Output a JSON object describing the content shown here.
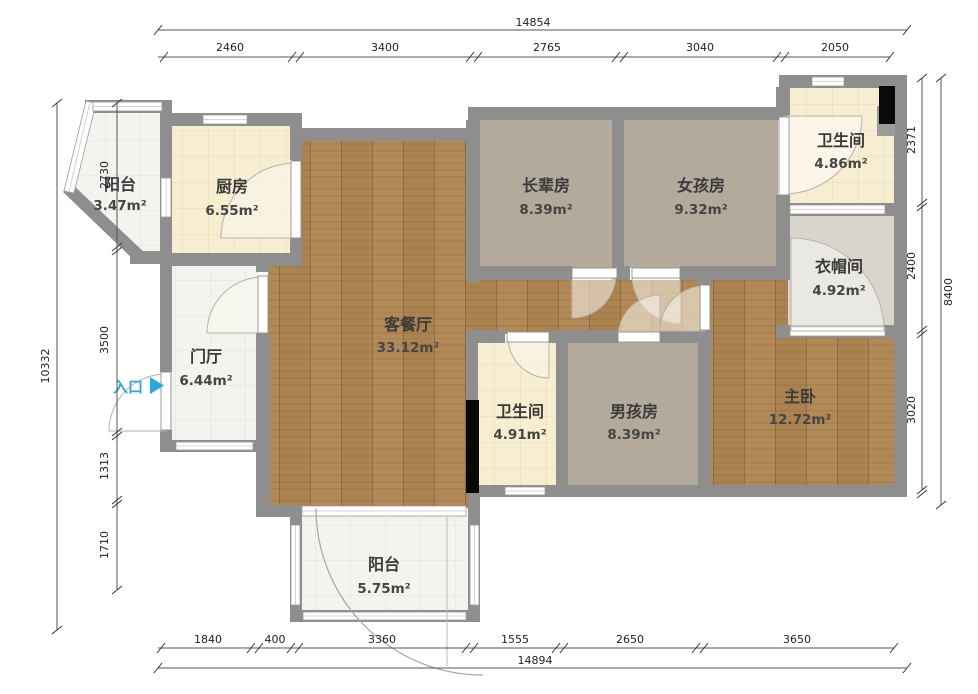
{
  "plan": {
    "title": "apartment floor plan"
  },
  "rooms": [
    {
      "id": "balcony-top",
      "name": "阳台",
      "area": "3.47m²"
    },
    {
      "id": "kitchen",
      "name": "厨房",
      "area": "6.55m²"
    },
    {
      "id": "living-dining",
      "name": "客餐厅",
      "area": "33.12m²"
    },
    {
      "id": "foyer",
      "name": "门厅",
      "area": "6.44m²"
    },
    {
      "id": "elder-room",
      "name": "长辈房",
      "area": "8.39m²"
    },
    {
      "id": "girl-room",
      "name": "女孩房",
      "area": "9.32m²"
    },
    {
      "id": "bathroom-top",
      "name": "卫生间",
      "area": "4.86m²"
    },
    {
      "id": "cloakroom",
      "name": "衣帽间",
      "area": "4.92m²"
    },
    {
      "id": "bathroom-mid",
      "name": "卫生间",
      "area": "4.91m²"
    },
    {
      "id": "boy-room",
      "name": "男孩房",
      "area": "8.39m²"
    },
    {
      "id": "master-bedroom",
      "name": "主卧",
      "area": "12.72m²"
    },
    {
      "id": "balcony-bottom",
      "name": "阳台",
      "area": "5.75m²"
    }
  ],
  "entrance": {
    "label": "入口"
  },
  "dims": {
    "top": {
      "total": "14854",
      "segments": [
        "2460",
        "3400",
        "2765",
        "3040",
        "2050"
      ]
    },
    "bottom": {
      "total": "14894",
      "segments": [
        "1840",
        "400",
        "3360",
        "1555",
        "2650",
        "3650"
      ]
    },
    "left": {
      "total": "10332",
      "segments": [
        "2730",
        "3500",
        "1313",
        "1710"
      ]
    },
    "right": {
      "total": "8400",
      "segments": [
        "2371",
        "2400",
        "3020"
      ]
    }
  },
  "colors": {
    "wall": "#8e8e8e",
    "wood_floor": "#b28a58",
    "bedroom_floor": "#b3aa9b",
    "warm_tile": "#f7edd0",
    "light_tile": "#f3f3f0",
    "cloakroom_floor": "#d9d5cc",
    "entrance_blue": "#2aa7df",
    "fixture_black": "#0a0a0a"
  }
}
